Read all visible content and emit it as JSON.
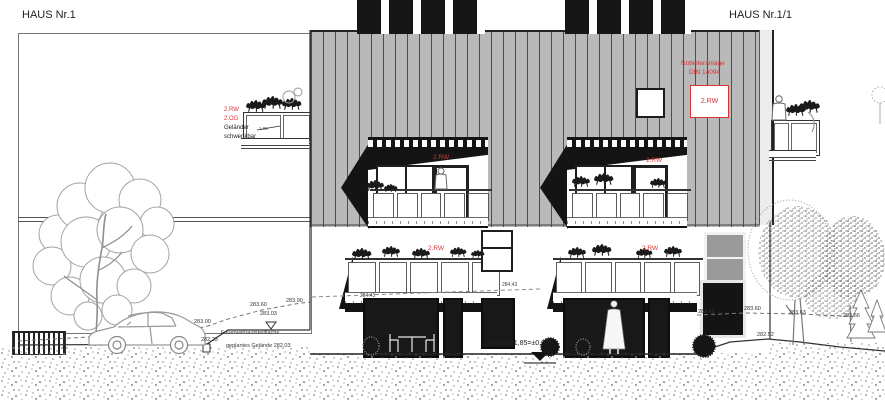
{
  "titles": {
    "left": "HAUS Nr.1",
    "right": "HAUS Nr.1/1"
  },
  "labels": {
    "rw": "2.RW",
    "og": "2.OG",
    "gelaender1": "Geländer",
    "gelaender2": "schwenkbar",
    "notleiter1": "Notleiteranlage",
    "notleiter2": "DIN 14094",
    "feuerwehr": "Feuerwehraufstellfläche",
    "geplantes_gelaende": "geplantes Gelände 282.03",
    "rfb": "RFB 281,85=±0,00",
    "railing_dim": "1.00"
  },
  "elevations": {
    "left_283_00": "283.00",
    "left_283_60": "283.60",
    "left_283_90": "283.90",
    "left_283_03": "283.03",
    "left_282_23": "282.23",
    "mid_284_43": "284.43",
    "right_283_65": "283.65",
    "right_283_60": "283.60",
    "right_283_63": "283.63",
    "right_283_66": "283.66",
    "right_282_52": "282.52"
  },
  "colors": {
    "accent_red": "#d93434",
    "roof_gray": "#b9b9b9",
    "ink": "#1a1a1a"
  }
}
